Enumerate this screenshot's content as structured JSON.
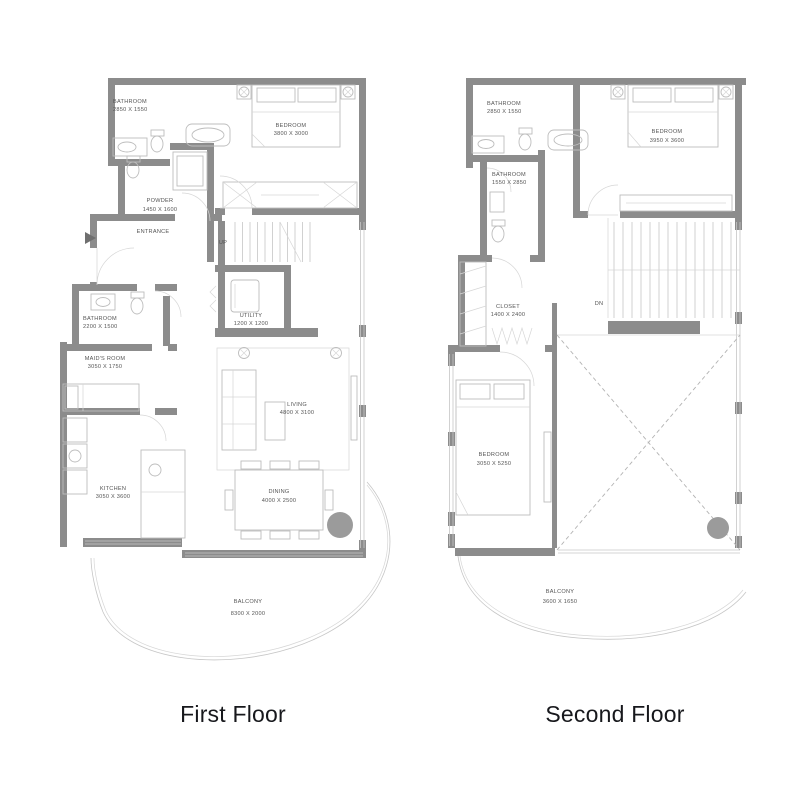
{
  "colors": {
    "wall": "#8c8c8c",
    "thin_line": "#c6c6c6",
    "fixture": "#bdbdbd",
    "label_text": "#555555",
    "title_text": "#17181c",
    "column": "#9b9b9b",
    "background": "#ffffff"
  },
  "floors": [
    {
      "title": "First Floor",
      "labels": {
        "bathroom_top": {
          "name": "BATHROOM",
          "dims": "2850 X 1550"
        },
        "bedroom": {
          "name": "BEDROOM",
          "dims": "3800 X 3000"
        },
        "powder": {
          "name": "POWDER",
          "dims": "1450 X 1600"
        },
        "entrance": {
          "name": "ENTRANCE"
        },
        "stairs": {
          "name": "UP"
        },
        "bathroom_left": {
          "name": "BATHROOM",
          "dims": "2200 X 1500"
        },
        "maids_room": {
          "name": "MAID'S ROOM",
          "dims": "3050 X 1750"
        },
        "utility": {
          "name": "UTILITY",
          "dims": "1200 X 1200"
        },
        "living": {
          "name": "LIVING",
          "dims": "4800 X 3100"
        },
        "kitchen": {
          "name": "KITCHEN",
          "dims": "3050 X 3600"
        },
        "dining": {
          "name": "DINING",
          "dims": "4000 X 2500"
        },
        "balcony": {
          "name": "BALCONY",
          "dims": "8300 X 2000"
        }
      }
    },
    {
      "title": "Second Floor",
      "labels": {
        "bathroom_top": {
          "name": "BATHROOM",
          "dims": "2850 X 1550"
        },
        "bedroom_top": {
          "name": "BEDROOM",
          "dims": "3950 X 3600"
        },
        "bathroom_mid": {
          "name": "BATHROOM",
          "dims": "1550 X 2850"
        },
        "closet": {
          "name": "CLOSET",
          "dims": "1400 X 2400"
        },
        "stairs": {
          "name": "DN"
        },
        "bedroom_bottom": {
          "name": "BEDROOM",
          "dims": "3050 X 5250"
        },
        "balcony": {
          "name": "BALCONY",
          "dims": "3600 X 1650"
        }
      }
    }
  ]
}
